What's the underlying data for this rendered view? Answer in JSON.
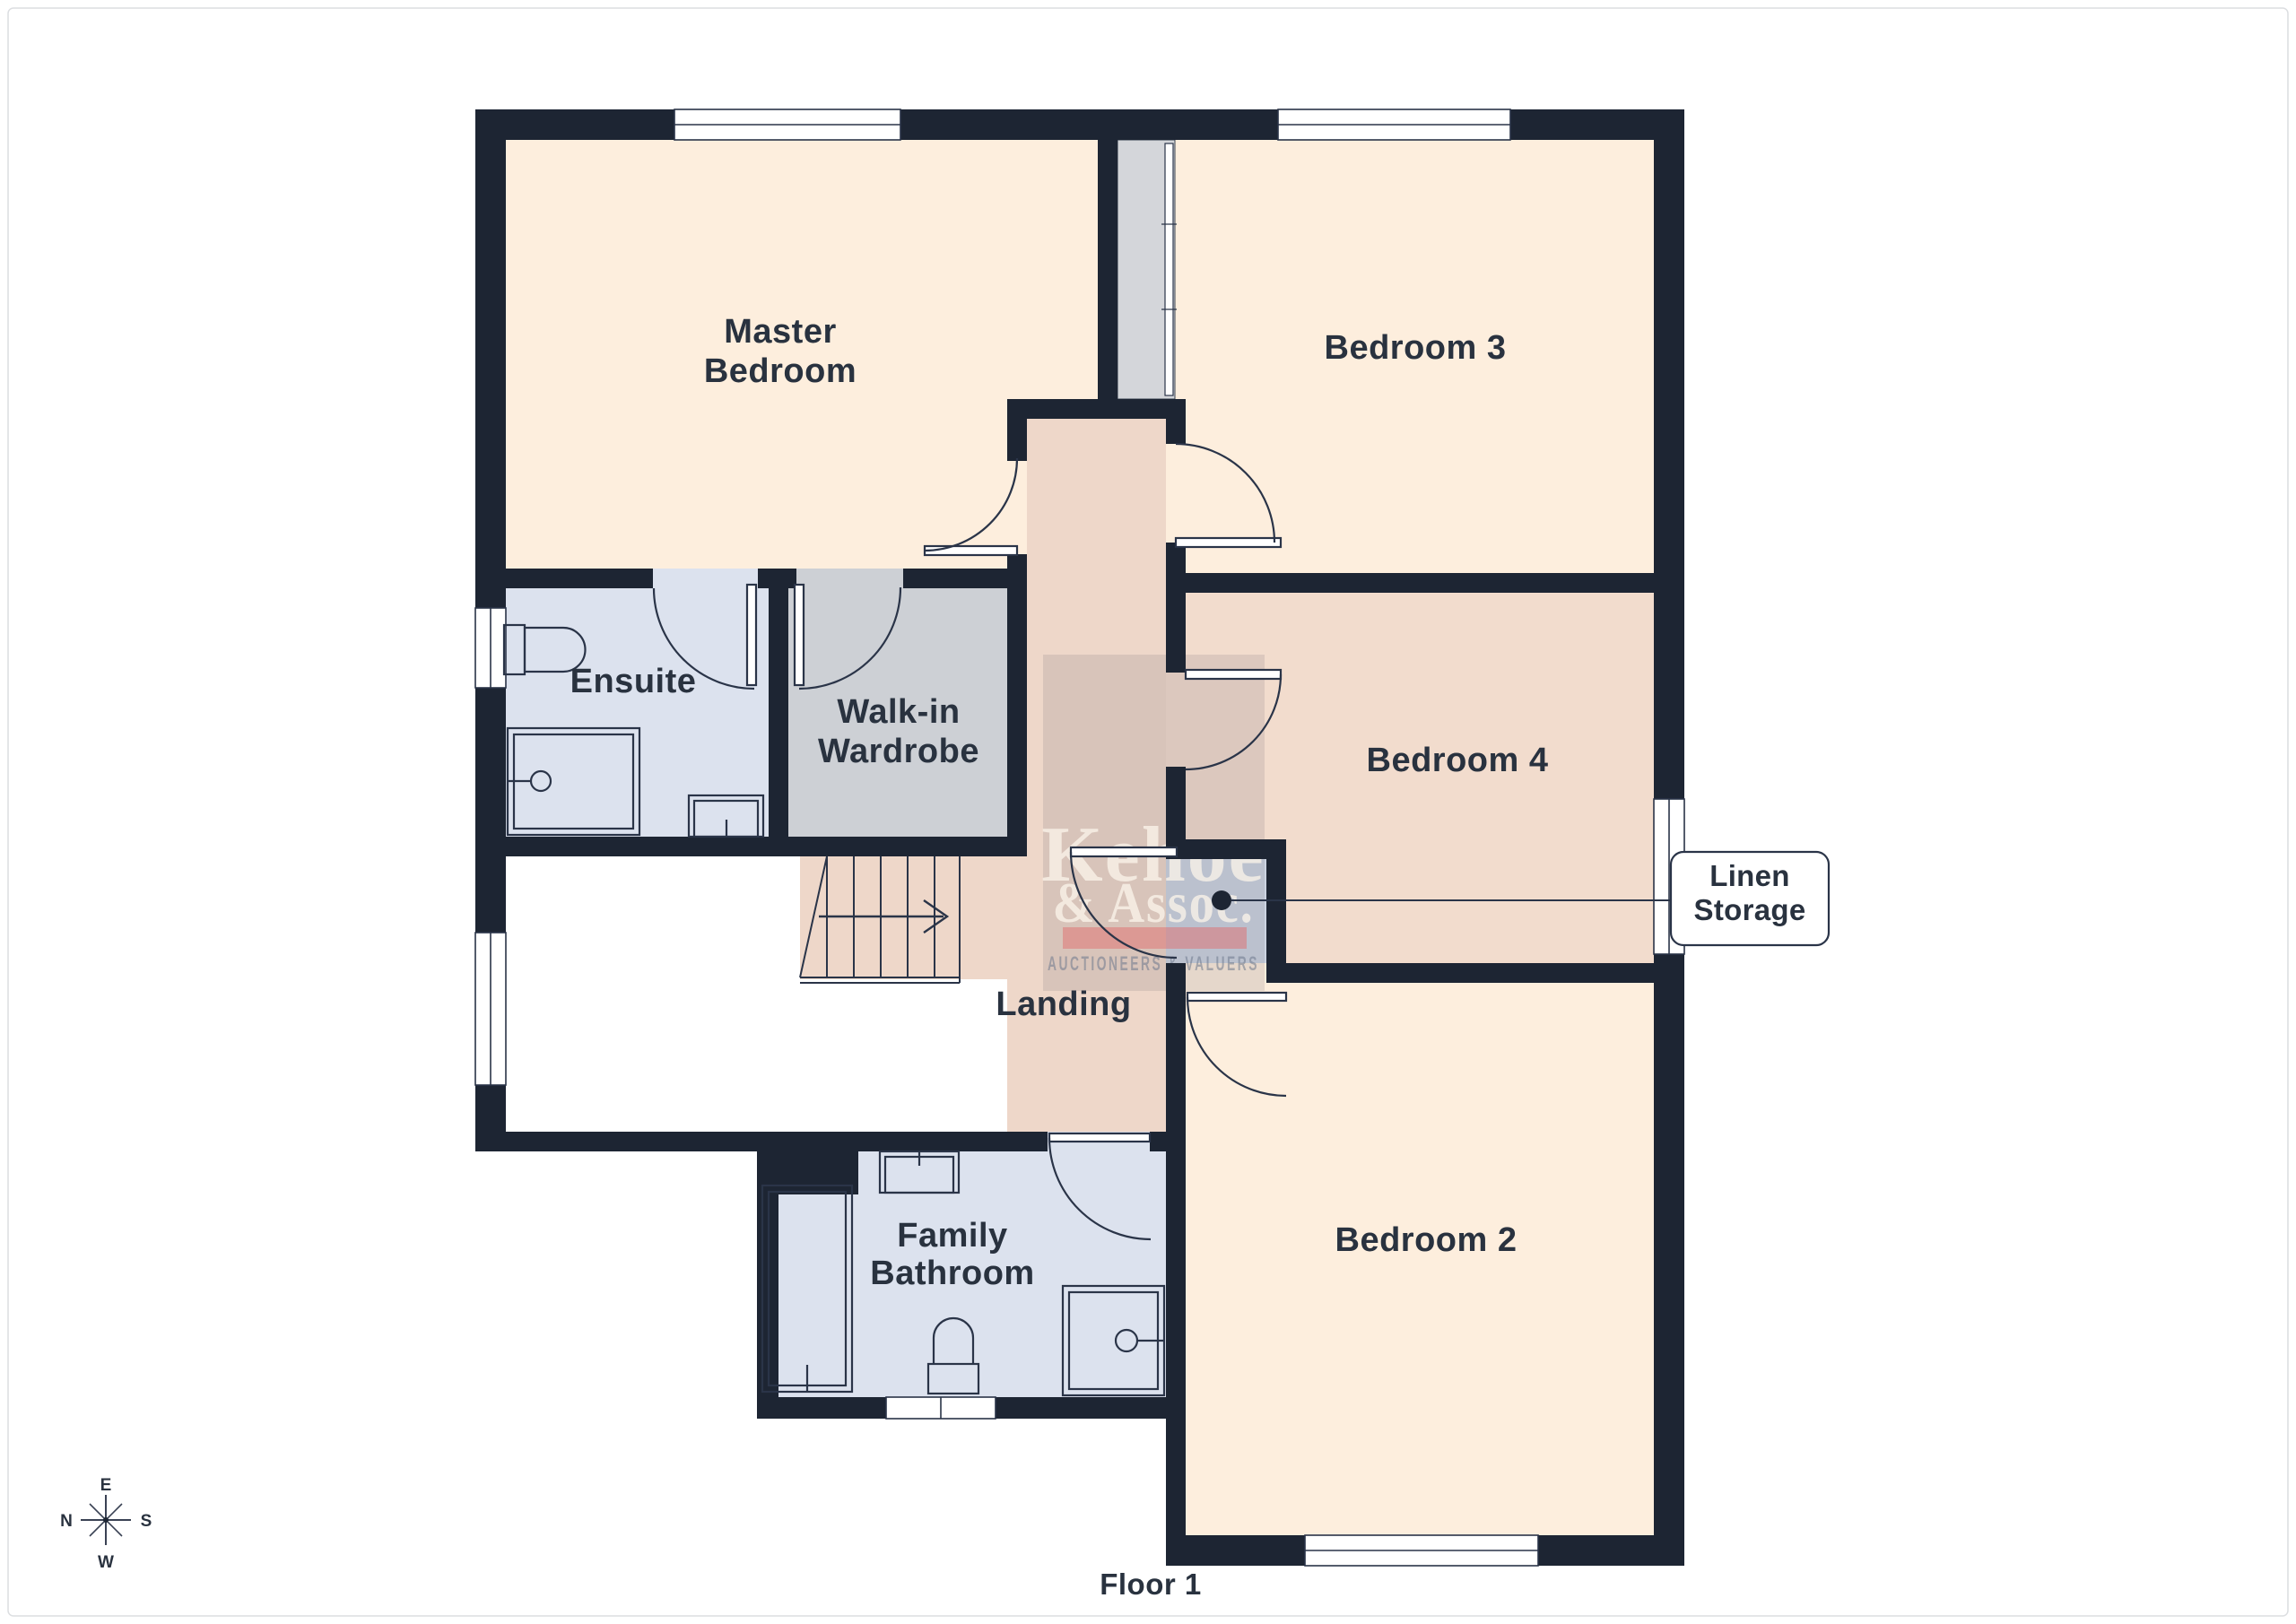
{
  "title": "Floor 1",
  "rooms": {
    "master_bedroom": {
      "line1": "Master",
      "line2": "Bedroom"
    },
    "bedroom3": {
      "label": "Bedroom 3"
    },
    "bedroom4": {
      "label": "Bedroom 4"
    },
    "bedroom2": {
      "label": "Bedroom 2"
    },
    "ensuite": {
      "label": "Ensuite"
    },
    "walk_in_wardrobe": {
      "line1": "Walk-in",
      "line2": "Wardrobe"
    },
    "landing": {
      "label": "Landing"
    },
    "family_bathroom": {
      "line1": "Family",
      "line2": "Bathroom"
    }
  },
  "callout": {
    "line1": "Linen",
    "line2": "Storage"
  },
  "compass": {
    "top": "E",
    "right": "S",
    "bottom": "W",
    "left": "N"
  },
  "watermark": {
    "name_line1": "Kehoe",
    "name_line2": "& Assoc.",
    "tagline": "AUCTIONEERS & VALUERS"
  },
  "icons": {
    "compass": "compass-rose-icon",
    "stairs_arrow": "stairs-up-arrow-icon"
  },
  "colors": {
    "wall": "#1d2533",
    "line": "#2a3448",
    "label": "#29323f",
    "peach": "#fdeedd",
    "landing": "#eed7c9",
    "bedroom4": "#f2dccd",
    "wet_room": "#dce2ee",
    "wardrobe": "#cdd0d5",
    "chimney": "#d4d6da",
    "closet": "#cbd3e1",
    "window": "#ffffff",
    "watermark_red": "rgba(224,110,110,0.5)",
    "watermark_text": "rgba(250,244,233,0.78)",
    "watermark_tag": "rgba(110,120,140,0.55)",
    "watermark_veil": "rgba(105,100,110,0.16)",
    "page_border": "#dcdee1"
  }
}
